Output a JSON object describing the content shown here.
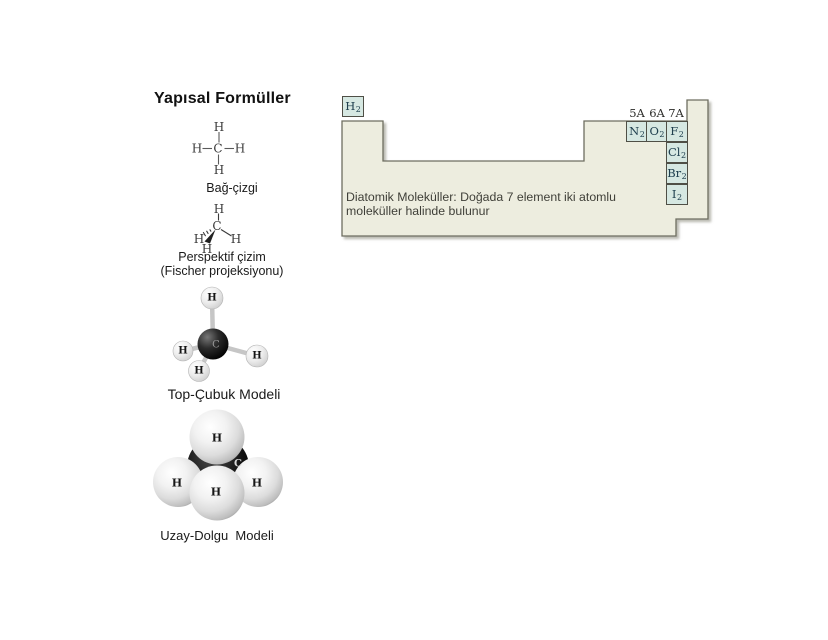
{
  "left_panel": {
    "title": "Yapısal Formüller",
    "bond_line": {
      "label": "Bağ-çizgi",
      "atoms": {
        "top": "H",
        "left": "H",
        "center": "C",
        "right": "H",
        "bottom": "H"
      }
    },
    "perspective": {
      "label_line1": "Perspektif çizim",
      "label_line2": "(Fischer projeksiyonu)",
      "atoms": {
        "top": "H",
        "left": "H",
        "center": "C",
        "right": "H",
        "bottom": "H"
      }
    },
    "ball_stick": {
      "label": "Top-Çubuk Modeli",
      "atoms": {
        "center": "C",
        "top": "H",
        "left": "H",
        "right": "H",
        "bottom": "H"
      }
    },
    "space_fill": {
      "label": "Uzay-Dolgu  Modeli",
      "atoms": {
        "center": "C",
        "top": "H",
        "left": "H",
        "right": "H",
        "front": "H"
      }
    }
  },
  "periodic_table": {
    "caption_line1": "Diatomik Moleküller: Doğada 7 element iki atomlu",
    "caption_line2": "moleküller halinde bulunur",
    "group_labels": [
      "5A",
      "6A",
      "7A"
    ],
    "cells": [
      {
        "symbol": "H",
        "subscript": "2"
      },
      {
        "symbol": "N",
        "subscript": "2"
      },
      {
        "symbol": "O",
        "subscript": "2"
      },
      {
        "symbol": "F",
        "subscript": "2"
      },
      {
        "symbol": "Cl",
        "subscript": "2"
      },
      {
        "symbol": "Br",
        "subscript": "2"
      },
      {
        "symbol": "I",
        "subscript": "2"
      }
    ],
    "colors": {
      "table_fill": "#EDEDDF",
      "table_border": "#6E6E60",
      "cell_fill": "#D6E8E2",
      "cell_border": "#4F4F46",
      "symbol_color": "#20404F"
    }
  }
}
